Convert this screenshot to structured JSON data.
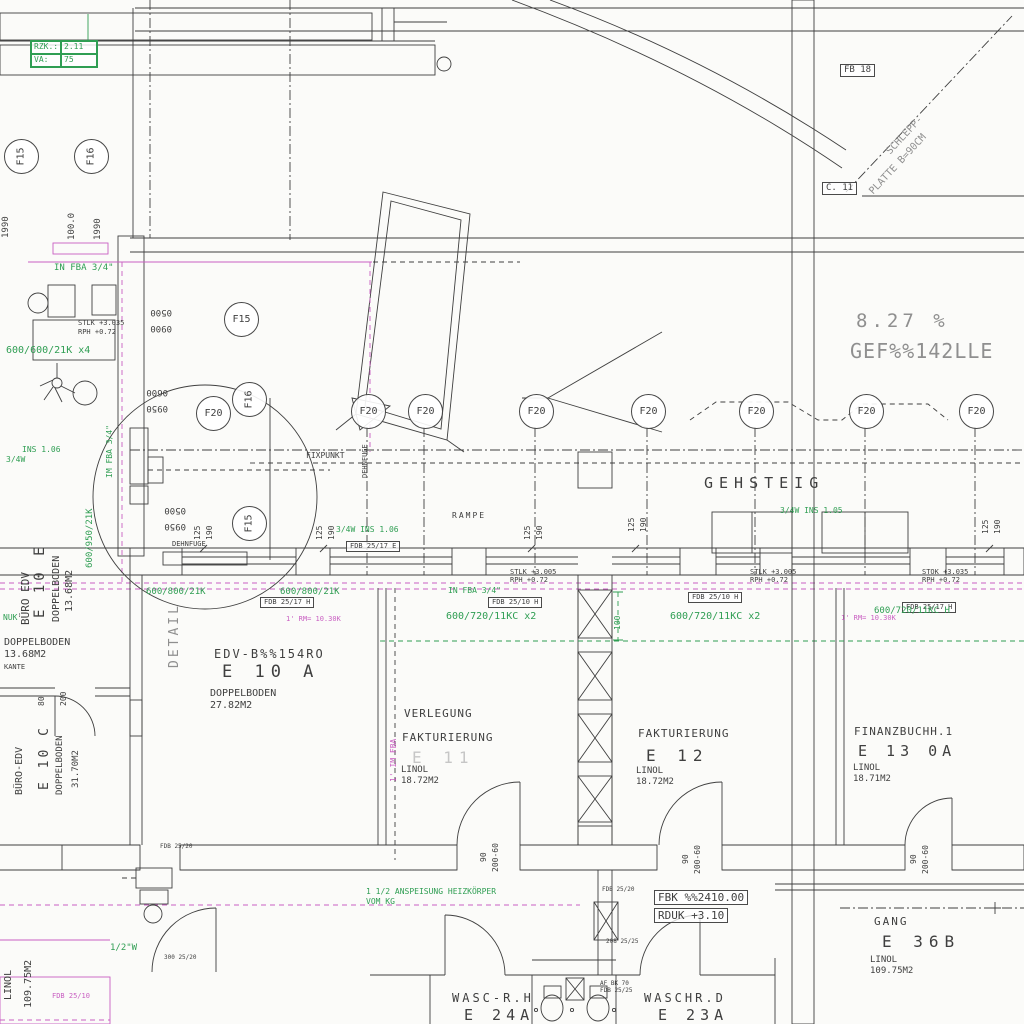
{
  "drawing": {
    "colors": {
      "k": "#3f3f3f",
      "g": "#2f9e53",
      "m": "#c95fc2",
      "y": "#8f8f8f",
      "gh": "#c6c6c6",
      "pink": "#c9607c"
    },
    "legend_box": {
      "rows": [
        {
          "label": "RZK.:",
          "value": "2.11"
        },
        {
          "label": "VA:",
          "value": "75"
        }
      ]
    },
    "grid_markers": [
      {
        "label": "F15",
        "x": 20,
        "y": 155,
        "rot": -90
      },
      {
        "label": "F16",
        "x": 90,
        "y": 155,
        "rot": -90
      },
      {
        "label": "F15",
        "x": 240,
        "y": 318,
        "rot": 0
      },
      {
        "label": "F16",
        "x": 248,
        "y": 398,
        "rot": -90
      },
      {
        "label": "F20",
        "x": 212,
        "y": 412,
        "rot": 0
      },
      {
        "label": "F20",
        "x": 367,
        "y": 410,
        "rot": 0
      },
      {
        "label": "F20",
        "x": 424,
        "y": 410,
        "rot": 0
      },
      {
        "label": "F20",
        "x": 535,
        "y": 410,
        "rot": 0
      },
      {
        "label": "F20",
        "x": 647,
        "y": 410,
        "rot": 0
      },
      {
        "label": "F20",
        "x": 755,
        "y": 410,
        "rot": 0
      },
      {
        "label": "F20",
        "x": 865,
        "y": 410,
        "rot": 0
      },
      {
        "label": "F20",
        "x": 975,
        "y": 410,
        "rot": 0
      },
      {
        "label": "F15",
        "x": 248,
        "y": 522,
        "rot": -90
      }
    ],
    "rooms": [
      {
        "name": "EDV-B%%154RO",
        "number": "E 10 A",
        "floor": "DOPPELBODEN",
        "area": "27.82M2"
      },
      {
        "name": "BÜRO EDV",
        "number": "E 10 E",
        "floor": "DOPPELBODEN",
        "area": "13.68M2"
      },
      {
        "name": "BÜRO-EDV",
        "number": "E 10 C",
        "floor": "DOPPELBODEN",
        "area": "31.70M2"
      },
      {
        "name": "VERLEGUNG FAKTURIERUNG",
        "number": "E 11",
        "floor": "LINOL",
        "area": "18.72M2"
      },
      {
        "name": "FAKTURIERUNG",
        "number": "E 12",
        "floor": "LINOL",
        "area": "18.72M2"
      },
      {
        "name": "FINANZBUCHH.1",
        "number": "E 13 0A",
        "floor": "LINOL",
        "area": "18.71M2"
      },
      {
        "name": "GANG",
        "number": "E 36B",
        "floor": "LINOL",
        "area": "109.75M2"
      },
      {
        "name": "WASC-R.H",
        "number": "E 24A"
      },
      {
        "name": "WASCHR.D",
        "number": "E 23A"
      }
    ],
    "labels": [
      {
        "t": "1990",
        "x": 2,
        "y": 238,
        "s": 9,
        "c": "k",
        "r": -90
      },
      {
        "t": "100.0",
        "x": 68,
        "y": 240,
        "s": 9,
        "c": "k",
        "r": -90
      },
      {
        "t": "1990",
        "x": 94,
        "y": 240,
        "s": 9,
        "c": "k",
        "r": -90
      },
      {
        "t": "IN FBA 3/4\"",
        "x": 54,
        "y": 264,
        "s": 9,
        "c": "g"
      },
      {
        "t": "STLK +3.035",
        "x": 78,
        "y": 320,
        "s": 7,
        "c": "k"
      },
      {
        "t": "RPH +0.72",
        "x": 78,
        "y": 329,
        "s": 7,
        "c": "k"
      },
      {
        "t": "0500",
        "x": 172,
        "y": 316,
        "s": 9,
        "c": "k",
        "r": 180
      },
      {
        "t": "0900",
        "x": 172,
        "y": 332,
        "s": 9,
        "c": "k",
        "r": 180
      },
      {
        "t": "600/600/21K x4",
        "x": 6,
        "y": 346,
        "s": 10,
        "c": "g"
      },
      {
        "t": "0600",
        "x": 168,
        "y": 396,
        "s": 9,
        "c": "k",
        "r": 180
      },
      {
        "t": "0950",
        "x": 168,
        "y": 412,
        "s": 9,
        "c": "k",
        "r": 180
      },
      {
        "t": "INS 1.06",
        "x": 22,
        "y": 446,
        "s": 8,
        "c": "g"
      },
      {
        "t": "3/4W",
        "x": 6,
        "y": 456,
        "s": 8,
        "c": "g"
      },
      {
        "t": "IM FBA 3/4\"",
        "x": 106,
        "y": 478,
        "s": 8,
        "c": "g",
        "r": -90
      },
      {
        "t": "600/950/21K",
        "x": 86,
        "y": 568,
        "s": 9,
        "c": "g",
        "r": -90
      },
      {
        "t": "0500",
        "x": 186,
        "y": 514,
        "s": 9,
        "c": "k",
        "r": 180
      },
      {
        "t": "0950",
        "x": 186,
        "y": 530,
        "s": 9,
        "c": "k",
        "r": 180
      },
      {
        "t": "125",
        "x": 194,
        "y": 540,
        "s": 8,
        "c": "k",
        "r": -90
      },
      {
        "t": "190",
        "x": 206,
        "y": 540,
        "s": 8,
        "c": "k",
        "r": -90
      },
      {
        "t": "DEHNFUGE",
        "x": 172,
        "y": 541,
        "s": 7,
        "c": "k"
      },
      {
        "t": "DEHNFUGE",
        "x": 362,
        "y": 478,
        "s": 7,
        "c": "k",
        "r": -90
      },
      {
        "t": "FIXPUNKT",
        "x": 306,
        "y": 452,
        "s": 8,
        "c": "k"
      },
      {
        "t": "RAMPE",
        "x": 452,
        "y": 512,
        "s": 8,
        "c": "k",
        "ls": 2
      },
      {
        "t": "3/4W INS 1.06",
        "x": 336,
        "y": 526,
        "s": 8,
        "c": "g"
      },
      {
        "t": "FDB 25/17 E",
        "x": 346,
        "y": 541,
        "s": 7,
        "c": "k",
        "box": true
      },
      {
        "t": "125",
        "x": 316,
        "y": 540,
        "s": 8,
        "c": "k",
        "r": -90
      },
      {
        "t": "190",
        "x": 328,
        "y": 540,
        "s": 8,
        "c": "k",
        "r": -90
      },
      {
        "t": "125",
        "x": 524,
        "y": 540,
        "s": 8,
        "c": "k",
        "r": -90
      },
      {
        "t": "190",
        "x": 536,
        "y": 540,
        "s": 8,
        "c": "k",
        "r": -90
      },
      {
        "t": "125",
        "x": 628,
        "y": 532,
        "s": 8,
        "c": "k",
        "r": -90
      },
      {
        "t": "190",
        "x": 640,
        "y": 532,
        "s": 8,
        "c": "k",
        "r": -90
      },
      {
        "t": "125",
        "x": 982,
        "y": 534,
        "s": 8,
        "c": "k",
        "r": -90
      },
      {
        "t": "190",
        "x": 994,
        "y": 534,
        "s": 8,
        "c": "k",
        "r": -90
      },
      {
        "t": "GEHSTEIG",
        "x": 704,
        "y": 476,
        "s": 15,
        "c": "k",
        "ls": 6,
        "n": "gehsteig-label"
      },
      {
        "t": "3/4W INS 1.05",
        "x": 780,
        "y": 507,
        "s": 8,
        "c": "g"
      },
      {
        "t": "8.27 %",
        "x": 856,
        "y": 312,
        "s": 19,
        "c": "y",
        "ls": 4,
        "n": "slope-percent"
      },
      {
        "t": "GEF%%142LLE",
        "x": 850,
        "y": 341,
        "s": 20,
        "c": "y",
        "ls": 1,
        "n": "slope-text"
      },
      {
        "t": "SCHLEPP-",
        "x": 885,
        "y": 150,
        "s": 10,
        "c": "y",
        "r": -47
      },
      {
        "t": "PLATTE B=90CM",
        "x": 868,
        "y": 190,
        "s": 10,
        "c": "y",
        "r": -47
      },
      {
        "t": "FB 18",
        "x": 840,
        "y": 64,
        "s": 9,
        "c": "k",
        "box": true
      },
      {
        "t": "C. 11",
        "x": 822,
        "y": 182,
        "s": 9,
        "c": "k",
        "box": true
      },
      {
        "t": "STLK +3.005",
        "x": 510,
        "y": 569,
        "s": 7,
        "c": "k"
      },
      {
        "t": "RPH +0.72",
        "x": 510,
        "y": 577,
        "s": 7,
        "c": "k"
      },
      {
        "t": "IN FBA 3/4\"",
        "x": 448,
        "y": 587,
        "s": 8,
        "c": "g"
      },
      {
        "t": "FDB 25/10 H",
        "x": 488,
        "y": 597,
        "s": 7,
        "c": "k",
        "box": true
      },
      {
        "t": "STLK +3.005",
        "x": 750,
        "y": 569,
        "s": 7,
        "c": "k"
      },
      {
        "t": "RPH +0.72",
        "x": 750,
        "y": 577,
        "s": 7,
        "c": "k"
      },
      {
        "t": "FDB 25/10 H",
        "x": 688,
        "y": 592,
        "s": 7,
        "c": "k",
        "box": true
      },
      {
        "t": "STOK +3.035",
        "x": 922,
        "y": 569,
        "s": 7,
        "c": "k"
      },
      {
        "t": "RPH +0.72",
        "x": 922,
        "y": 577,
        "s": 7,
        "c": "k"
      },
      {
        "t": "FDB 25/17 H",
        "x": 902,
        "y": 602,
        "s": 7,
        "c": "k",
        "box": true
      },
      {
        "t": "600/800/21K",
        "x": 146,
        "y": 588,
        "s": 9,
        "c": "g"
      },
      {
        "t": "600/800/21K",
        "x": 280,
        "y": 588,
        "s": 9,
        "c": "g"
      },
      {
        "t": "FDB 25/17 H",
        "x": 260,
        "y": 597,
        "s": 7,
        "c": "k",
        "box": true
      },
      {
        "t": "1' RM= 10.30K",
        "x": 286,
        "y": 616,
        "s": 7,
        "c": "m"
      },
      {
        "t": "1' RM= 10.30K",
        "x": 841,
        "y": 615,
        "s": 7,
        "c": "m"
      },
      {
        "t": "600/720/11KC x2",
        "x": 446,
        "y": 612,
        "s": 10,
        "c": "g"
      },
      {
        "t": "600/720/11KC x2",
        "x": 670,
        "y": 612,
        "s": 10,
        "c": "g"
      },
      {
        "t": "600/720/11KC H",
        "x": 874,
        "y": 607,
        "s": 9,
        "c": "g"
      },
      {
        "t": "100",
        "x": 614,
        "y": 630,
        "s": 8,
        "c": "g",
        "r": -90
      },
      {
        "t": "DETAIL",
        "x": 168,
        "y": 668,
        "s": 13,
        "c": "y",
        "r": -90,
        "ls": 3,
        "n": "detail-label"
      },
      {
        "t": "EDV-B%%154RO",
        "x": 214,
        "y": 648,
        "s": 12,
        "c": "k",
        "ls": 2,
        "n": "room-e10a-name"
      },
      {
        "t": "E 10 A",
        "x": 222,
        "y": 664,
        "s": 17,
        "c": "k",
        "ls": 6,
        "n": "room-e10a-number"
      },
      {
        "t": "DOPPELBODEN",
        "x": 210,
        "y": 689,
        "s": 10,
        "c": "k"
      },
      {
        "t": "27.82M2",
        "x": 210,
        "y": 701,
        "s": 10,
        "c": "k"
      },
      {
        "t": "BÜRO EDV",
        "x": 20,
        "y": 625,
        "s": 11,
        "c": "k",
        "r": -90,
        "n": "room-e10e-name"
      },
      {
        "t": "E 10 E",
        "x": 33,
        "y": 618,
        "s": 14,
        "c": "k",
        "r": -90,
        "ls": 4,
        "n": "room-e10e-number"
      },
      {
        "t": "DOPPELBODEN",
        "x": 52,
        "y": 622,
        "s": 10,
        "c": "k",
        "r": -90
      },
      {
        "t": "13.68M2",
        "x": 65,
        "y": 612,
        "s": 10,
        "c": "k",
        "r": -90
      },
      {
        "t": "NUK",
        "x": 3,
        "y": 614,
        "s": 8,
        "c": "g"
      },
      {
        "t": "DOPPELBODEN",
        "x": 4,
        "y": 638,
        "s": 10,
        "c": "k"
      },
      {
        "t": "13.68M2",
        "x": 4,
        "y": 650,
        "s": 10,
        "c": "k"
      },
      {
        "t": "KANTE",
        "x": 4,
        "y": 664,
        "s": 7,
        "c": "k"
      },
      {
        "t": "80",
        "x": 38,
        "y": 706,
        "s": 8,
        "c": "k",
        "r": -90
      },
      {
        "t": "200",
        "x": 60,
        "y": 706,
        "s": 8,
        "c": "k",
        "r": -90
      },
      {
        "t": "BÜRO-EDV",
        "x": 15,
        "y": 795,
        "s": 10,
        "c": "k",
        "r": -90,
        "n": "room-e10c-name"
      },
      {
        "t": "E 10 C",
        "x": 38,
        "y": 790,
        "s": 13,
        "c": "k",
        "r": -90,
        "ls": 3,
        "n": "room-e10c-number"
      },
      {
        "t": "DOPPELBODEN",
        "x": 56,
        "y": 795,
        "s": 9,
        "c": "k",
        "r": -90
      },
      {
        "t": "31.70M2",
        "x": 72,
        "y": 788,
        "s": 9,
        "c": "k",
        "r": -90
      },
      {
        "t": "1' IM FBA",
        "x": 390,
        "y": 782,
        "s": 8,
        "c": "m",
        "r": -90
      },
      {
        "t": "VERLEGUNG",
        "x": 404,
        "y": 708,
        "s": 11,
        "c": "k",
        "ls": 1,
        "n": "room-e11-name"
      },
      {
        "t": "FAKTURIERUNG",
        "x": 402,
        "y": 732,
        "s": 11,
        "c": "k",
        "ls": 1
      },
      {
        "t": "E 11",
        "x": 412,
        "y": 750,
        "s": 16,
        "c": "gh",
        "ls": 6,
        "n": "room-e11-number"
      },
      {
        "t": "LINOL",
        "x": 401,
        "y": 766,
        "s": 9,
        "c": "k"
      },
      {
        "t": "18.72M2",
        "x": 401,
        "y": 777,
        "s": 9,
        "c": "k"
      },
      {
        "t": "FAKTURIERUNG",
        "x": 638,
        "y": 728,
        "s": 11,
        "c": "k",
        "ls": 1,
        "n": "room-e12-name"
      },
      {
        "t": "E 12",
        "x": 646,
        "y": 748,
        "s": 16,
        "c": "k",
        "ls": 6,
        "n": "room-e12-number"
      },
      {
        "t": "LINOL",
        "x": 636,
        "y": 767,
        "s": 9,
        "c": "k"
      },
      {
        "t": "18.72M2",
        "x": 636,
        "y": 778,
        "s": 9,
        "c": "k"
      },
      {
        "t": "FINANZBUCHH.1",
        "x": 854,
        "y": 726,
        "s": 11,
        "c": "k",
        "ls": 1,
        "n": "room-e13-name"
      },
      {
        "t": "E 13 0A",
        "x": 858,
        "y": 744,
        "s": 15,
        "c": "k",
        "ls": 5,
        "n": "room-e13-number"
      },
      {
        "t": "LINOL",
        "x": 853,
        "y": 764,
        "s": 9,
        "c": "k"
      },
      {
        "t": "18.71M2",
        "x": 853,
        "y": 775,
        "s": 9,
        "c": "k"
      },
      {
        "t": "90",
        "x": 480,
        "y": 862,
        "s": 8,
        "c": "k",
        "r": -90
      },
      {
        "t": "200-60",
        "x": 492,
        "y": 872,
        "s": 8,
        "c": "k",
        "r": -90
      },
      {
        "t": "90",
        "x": 682,
        "y": 864,
        "s": 8,
        "c": "k",
        "r": -90
      },
      {
        "t": "200-60",
        "x": 694,
        "y": 874,
        "s": 8,
        "c": "k",
        "r": -90
      },
      {
        "t": "90",
        "x": 910,
        "y": 864,
        "s": 8,
        "c": "k",
        "r": -90
      },
      {
        "t": "200-60",
        "x": 922,
        "y": 874,
        "s": 8,
        "c": "k",
        "r": -90
      },
      {
        "t": "1 1/2 ANSPEISUNG HEIZKÖRPER",
        "x": 366,
        "y": 888,
        "s": 8,
        "c": "g",
        "n": "heating-note"
      },
      {
        "t": "VOM KG",
        "x": 366,
        "y": 898,
        "s": 8,
        "c": "g"
      },
      {
        "t": "FDB 25/20",
        "x": 602,
        "y": 887,
        "s": 6,
        "c": "k"
      },
      {
        "t": "208 25/25",
        "x": 606,
        "y": 939,
        "s": 6,
        "c": "k"
      },
      {
        "t": "FBK %%2410.00",
        "x": 654,
        "y": 890,
        "s": 11,
        "c": "k",
        "box": true,
        "n": "level-fbk"
      },
      {
        "t": "RDUK +3.10",
        "x": 654,
        "y": 908,
        "s": 11,
        "c": "k",
        "box": true,
        "n": "level-rduk"
      },
      {
        "t": "FDB 25/20",
        "x": 160,
        "y": 844,
        "s": 6,
        "c": "k"
      },
      {
        "t": "GANG",
        "x": 874,
        "y": 916,
        "s": 11,
        "c": "k",
        "ls": 2,
        "n": "room-e36b-name"
      },
      {
        "t": "E 36B",
        "x": 882,
        "y": 934,
        "s": 16,
        "c": "k",
        "ls": 6,
        "n": "room-e36b-number"
      },
      {
        "t": "LINOL",
        "x": 870,
        "y": 956,
        "s": 9,
        "c": "k"
      },
      {
        "t": "109.75M2",
        "x": 870,
        "y": 967,
        "s": 9,
        "c": "k"
      },
      {
        "t": "LINOL",
        "x": 4,
        "y": 1000,
        "s": 10,
        "c": "k",
        "r": -90
      },
      {
        "t": "109.75M2",
        "x": 24,
        "y": 1008,
        "s": 10,
        "c": "k",
        "r": -90
      },
      {
        "t": "1/2\"W",
        "x": 110,
        "y": 944,
        "s": 9,
        "c": "g"
      },
      {
        "t": "300 25/20",
        "x": 164,
        "y": 955,
        "s": 6,
        "c": "k"
      },
      {
        "t": "FDB 25/10",
        "x": 52,
        "y": 993,
        "s": 7,
        "c": "m"
      },
      {
        "t": "WASC-R.H",
        "x": 452,
        "y": 992,
        "s": 12,
        "c": "k",
        "ls": 3,
        "n": "room-e24a-name"
      },
      {
        "t": "E 24A",
        "x": 464,
        "y": 1008,
        "s": 15,
        "c": "k",
        "ls": 5,
        "n": "room-e24a-number"
      },
      {
        "t": "WASCHR.D",
        "x": 644,
        "y": 992,
        "s": 12,
        "c": "k",
        "ls": 3,
        "n": "room-e23a-name"
      },
      {
        "t": "E 23A",
        "x": 658,
        "y": 1008,
        "s": 15,
        "c": "k",
        "ls": 5,
        "n": "room-e23a-number"
      },
      {
        "t": "AF BK 70",
        "x": 600,
        "y": 981,
        "s": 6,
        "c": "k"
      },
      {
        "t": "FDB 25/25",
        "x": 600,
        "y": 988,
        "s": 6,
        "c": "k"
      }
    ]
  }
}
